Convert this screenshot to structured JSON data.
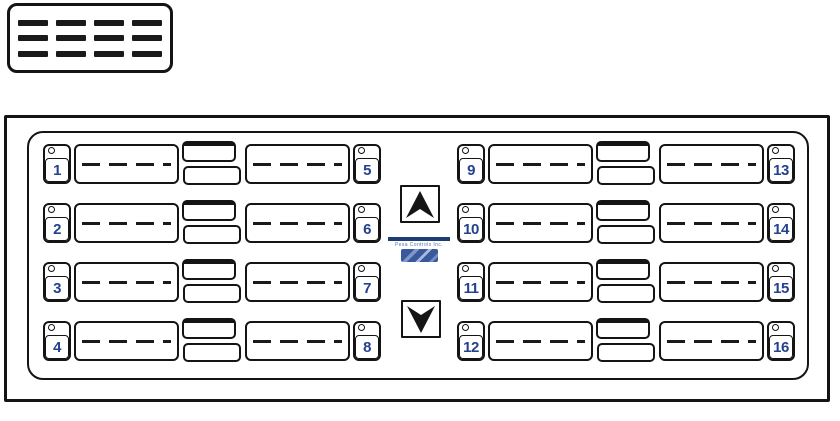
{
  "lcd": {
    "description": "blank display placeholder",
    "dash_rows": 3,
    "dashes_per_row": 4
  },
  "keypad": {
    "left_rows": [
      {
        "left": "1",
        "right": "5"
      },
      {
        "left": "2",
        "right": "6"
      },
      {
        "left": "3",
        "right": "7"
      },
      {
        "left": "4",
        "right": "8"
      }
    ],
    "right_rows": [
      {
        "left": "9",
        "right": "13"
      },
      {
        "left": "10",
        "right": "14"
      },
      {
        "left": "11",
        "right": "15"
      },
      {
        "left": "12",
        "right": "16"
      }
    ]
  },
  "center": {
    "up_arrow": "up-dart",
    "down_arrow": "down-dart",
    "logo": {
      "tagline": "Pesa Controls Inc.",
      "bar_color": "#1e3e73",
      "emblem_color": "#3b62a4"
    }
  },
  "colors": {
    "outline": "#141414",
    "digit_blue": "#24418e"
  }
}
